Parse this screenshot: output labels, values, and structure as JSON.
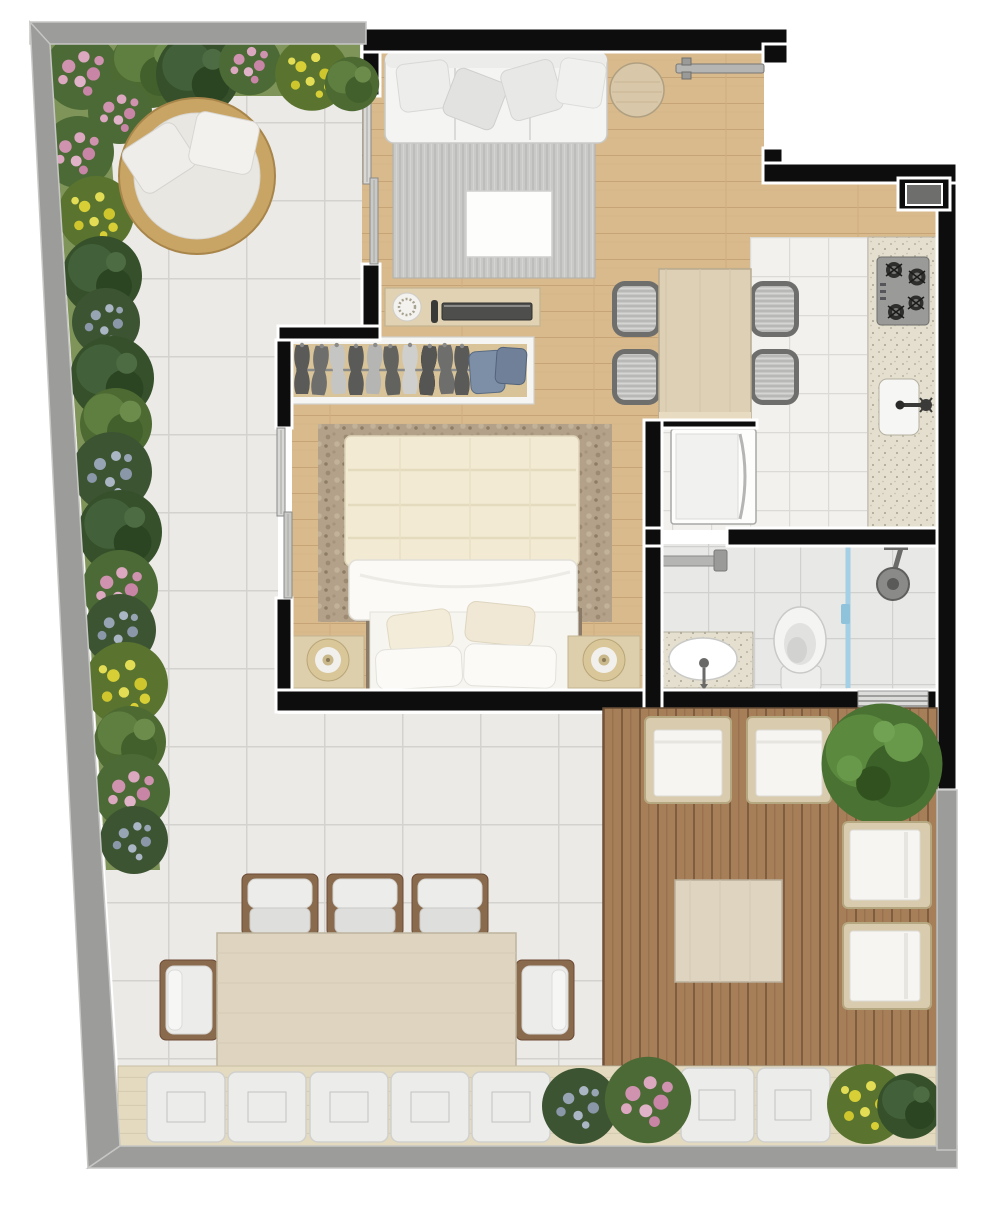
{
  "meta": {
    "label": "Apartment floor plan, top view render with garden terrace",
    "width_px": 1000,
    "height_px": 1216,
    "visible_text": "none"
  },
  "palette": {
    "exterior_background": "#ffffff",
    "outer_garden_wall_gray": "#9c9c9a",
    "interior_wall_black": "#0d0d0d",
    "wall_outline_white": "#ffffff",
    "garden_tile": "#ebeae7",
    "tile_grout": "#d3d2cf",
    "wood_floor": "#d9ba8d",
    "kitchen_tile": "#f2f1ee",
    "bathroom_tile": "#e8e8e6",
    "deck_wood": "#a67e58",
    "bench_wood": "#e4dabf",
    "counter_granite": "#e4dfcf",
    "sofa_white": "#f4f4f2",
    "bed_duvet_cream": "#f2ead2",
    "rug_living_gray": "#c9c9c7",
    "rug_bedroom_taupe": "#b3a289",
    "daybed_rattan": "#c9a565",
    "foliage_green": "#4d6a33",
    "flower_pink": "#cf93af",
    "flower_yellow": "#d7cf35",
    "flower_bluegray": "#97a4b4",
    "shower_glass_blue": "#a5cfe4",
    "appliance_gray": "#9a9a98"
  },
  "rooms": {
    "garden_terrace": {
      "label": "Garden terrace with white tile paving",
      "features": [
        "flower and shrub border along top and left walls",
        "round rattan daybed with white cushion and two pillows",
        "outdoor dining table with five visible chairs",
        "bottom bench with seven tufted cushions and four shrubs"
      ]
    },
    "living_room": {
      "label": "Living room",
      "features": [
        "three-seat white sofa with four pillows",
        "gray striped rug",
        "white coffee table",
        "round wooden side table",
        "entrance door near top-right"
      ]
    },
    "dining_area": {
      "label": "Dining area",
      "features": [
        "rectangular wood table",
        "four gray upholstered chairs"
      ]
    },
    "bedroom": {
      "label": "Bedroom",
      "features": [
        "double bed with cream duvet and four pillows",
        "taupe rug",
        "two nightstands with round lamps",
        "open wardrobe with ten hanging garments and two folded stacks",
        "sideboard with decorative plate, candle and media bar",
        "two sliding glass doors to garden"
      ]
    },
    "kitchen": {
      "label": "Kitchen strip",
      "features": [
        "granite counter along right wall",
        "four-burner cooktop",
        "single-basin sink with wall faucet",
        "washing machine niche",
        "service duct box in wall"
      ]
    },
    "bathroom": {
      "label": "Bathroom",
      "features": [
        "granite vanity with oval basin",
        "toilet",
        "walk-in shower with glass partition and shower head",
        "door leaf shown open",
        "ventilation window in bottom wall"
      ]
    },
    "deck": {
      "label": "Wood deck lounge",
      "features": [
        "two rattan armchairs facing down",
        "two rattan lounge chairs facing left",
        "square wood coffee table",
        "large green shrub"
      ]
    }
  },
  "counts": {
    "garden_border_bushes": 22,
    "bench_cushions": 7,
    "patio_dining_chairs": 5,
    "indoor_dining_chairs": 4,
    "deck_seats": 4,
    "wardrobe_garments": 10,
    "cooktop_burners": 4
  }
}
